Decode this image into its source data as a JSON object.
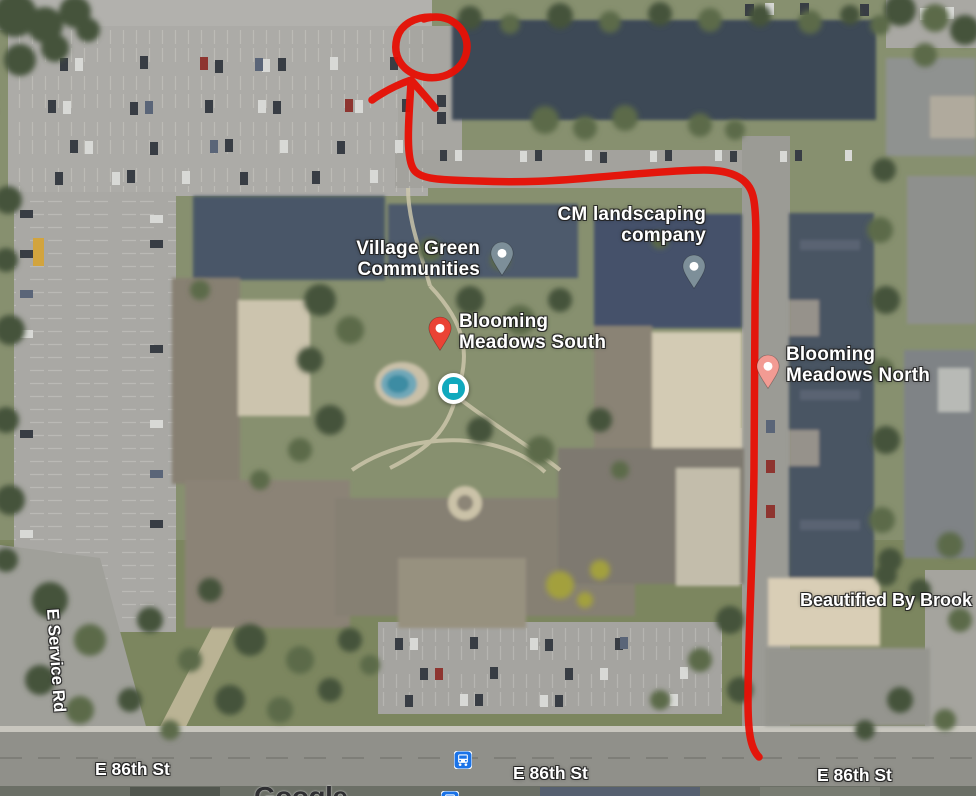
{
  "window": {
    "width": 976,
    "height": 796,
    "app": "Google Maps satellite view with hand-drawn route annotation"
  },
  "map": {
    "view_type": "satellite",
    "places": {
      "village_green": {
        "line1": "Village Green",
        "line2": "Communities",
        "pin_color": "#7d8f99"
      },
      "cm_landscaping": {
        "line1": "CM landscaping",
        "line2": "company",
        "pin_color": "#7d8f99"
      },
      "blooming_south": {
        "line1": "Blooming",
        "line2": "Meadows South",
        "pin_color": "#ea4335"
      },
      "blooming_north": {
        "line1": "Blooming",
        "line2": "Meadows North",
        "pin_color": "#f29b93"
      },
      "beautified": {
        "line1": "Beautified By Brook",
        "pin_color": "none"
      }
    },
    "roads": {
      "service_rd": "E Service Rd",
      "e86_left": "E 86th St",
      "e86_center": "E 86th St",
      "e86_right": "E 86th St",
      "edge_clipped": "E Service Rd"
    },
    "markers": {
      "current_place": {
        "type": "teal-square-marker",
        "color": "#11a9bd"
      },
      "bus_stop": {
        "type": "bus-icon",
        "color": "#1a73e8"
      }
    },
    "annotation": {
      "color": "#e61106",
      "shapes": [
        "circle",
        "arrow",
        "route-line"
      ],
      "description": "Red hand-drawn route from E 86th St north along the east driveway, west along the north drive, then north into a circled parking spot"
    },
    "watermark": "Google"
  }
}
